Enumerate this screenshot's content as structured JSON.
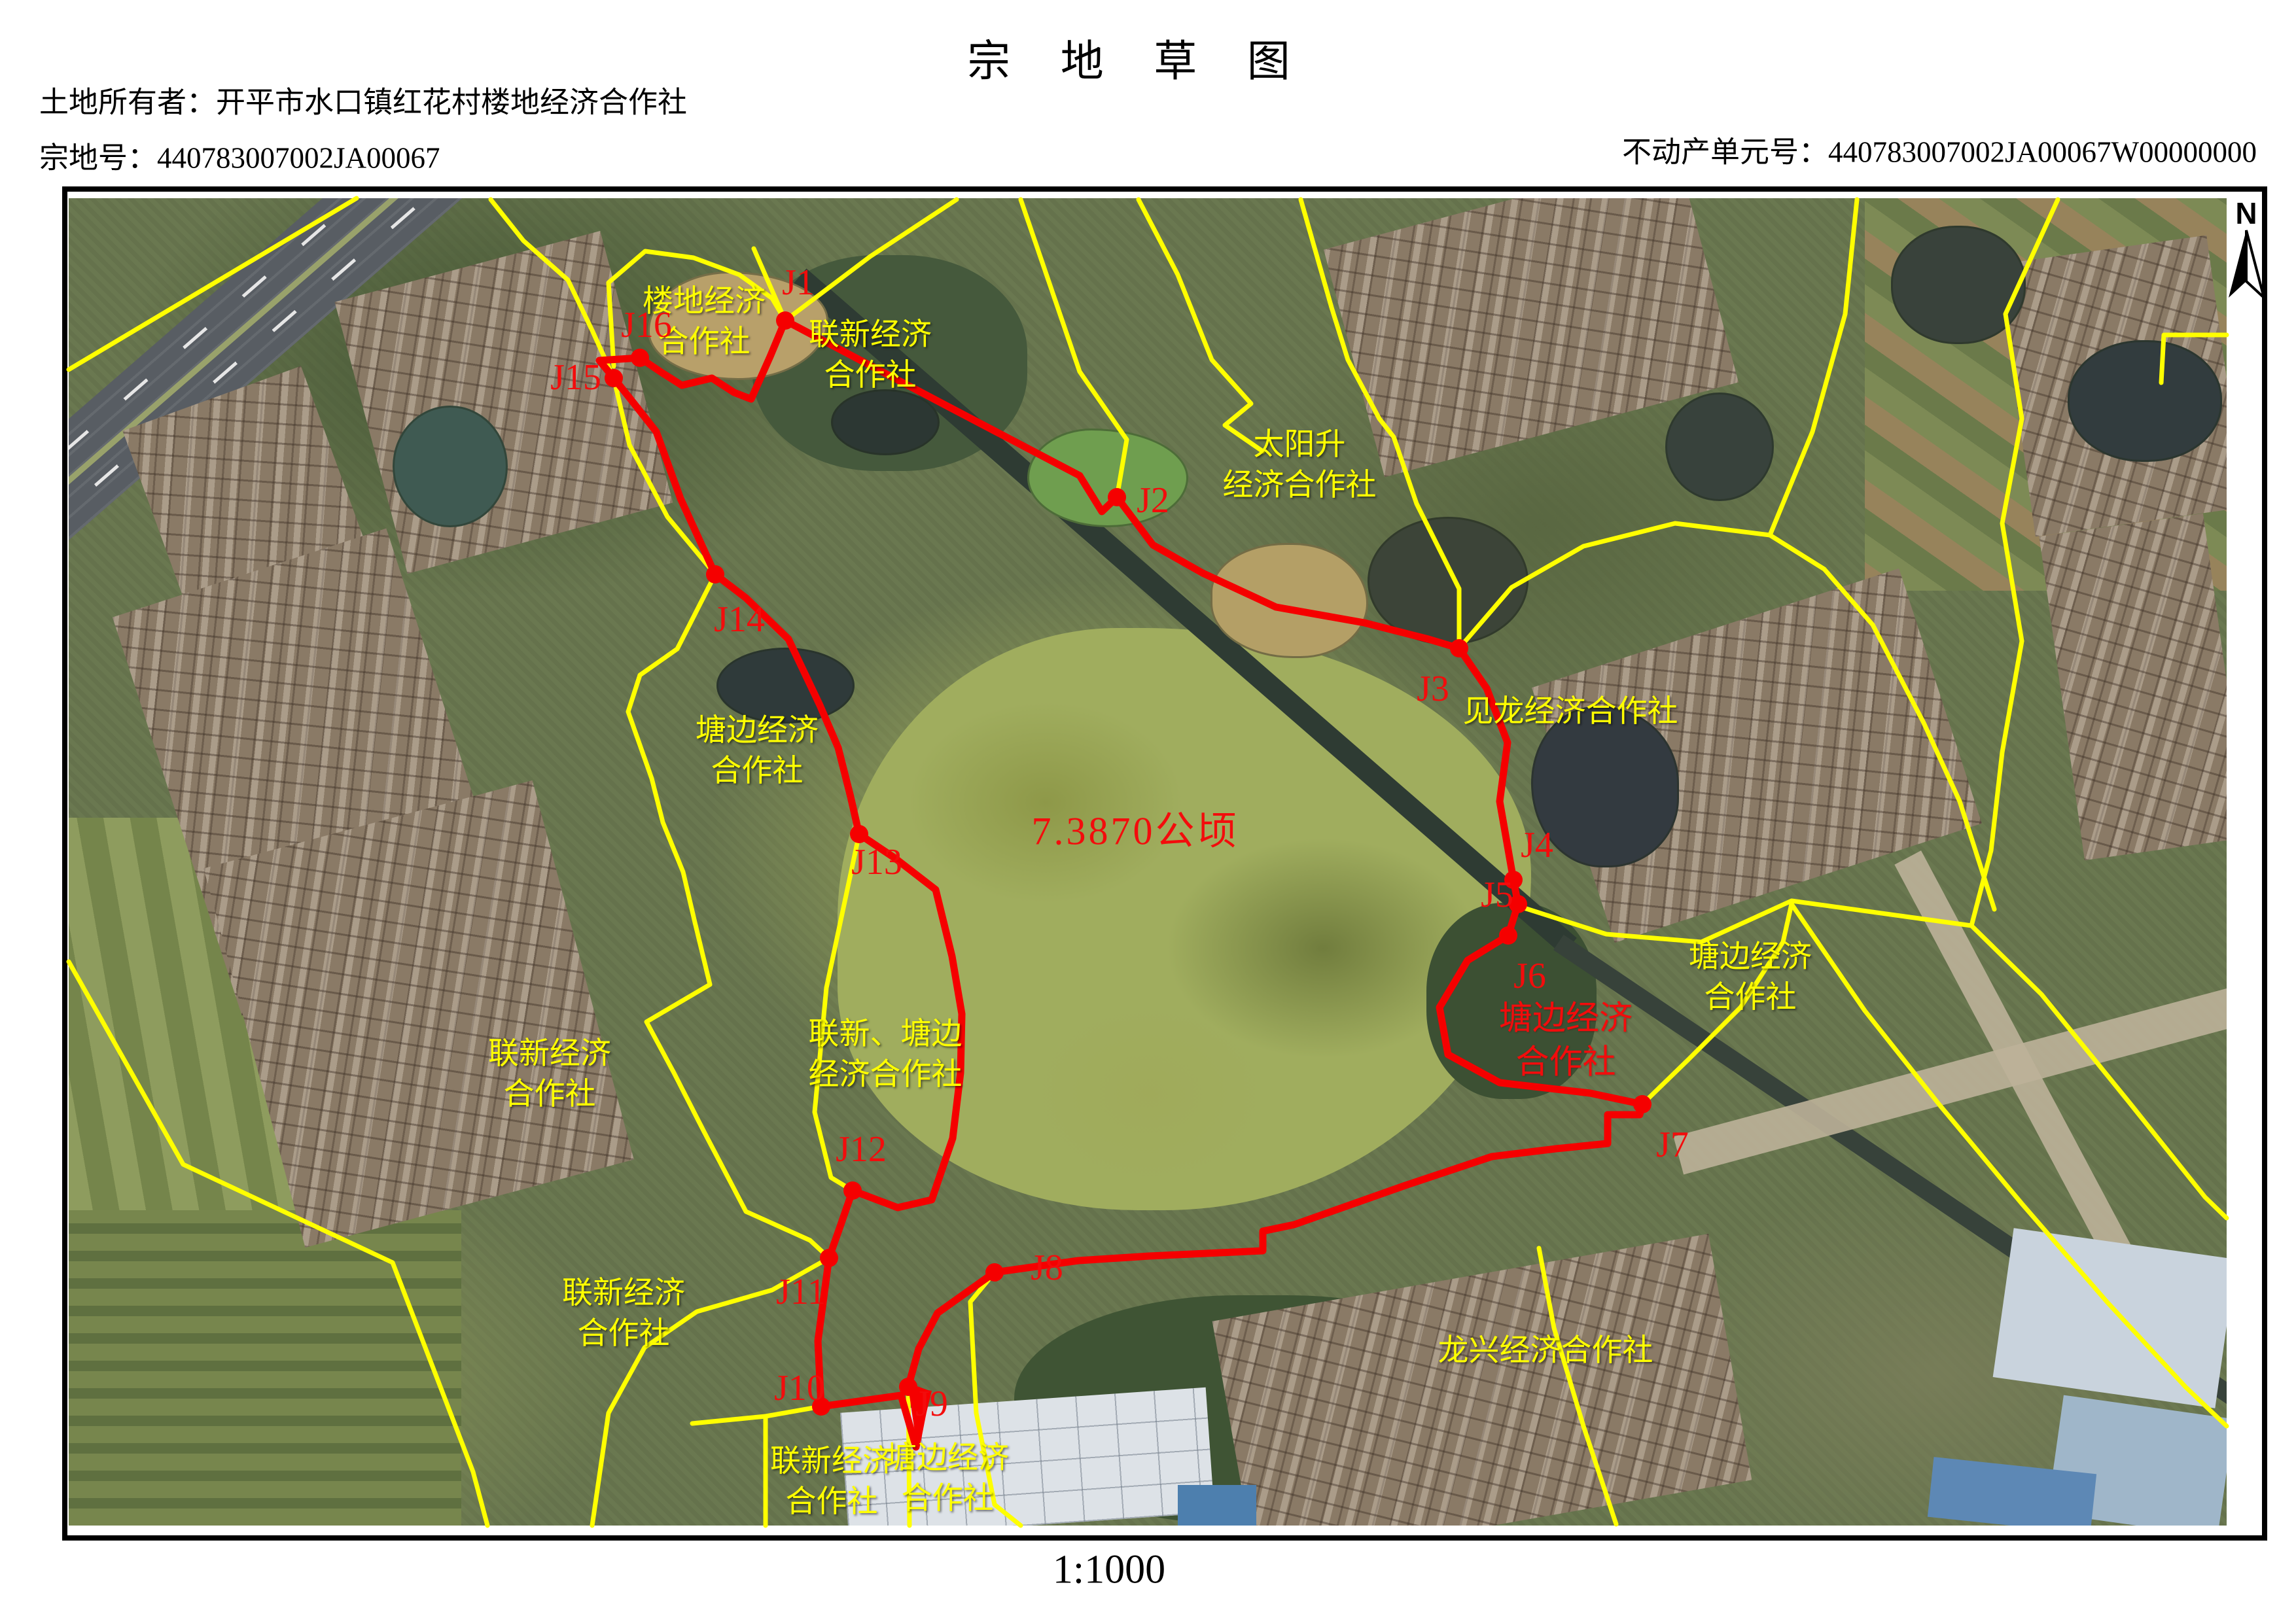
{
  "header": {
    "title": "宗 地 草 图",
    "owner": "土地所有者：开平市水口镇红花村楼地经济合作社",
    "parcel_no": "宗地号：440783007002JA00067",
    "unit_no": "不动产单元号：440783007002JA00067W00000000"
  },
  "map": {
    "north_label": "N",
    "scale_label": "1:1000",
    "area_label": "7.3870公顷",
    "points": [
      {
        "id": "J1"
      },
      {
        "id": "J2"
      },
      {
        "id": "J3"
      },
      {
        "id": "J4"
      },
      {
        "id": "J5"
      },
      {
        "id": "J6"
      },
      {
        "id": "J7"
      },
      {
        "id": "J8"
      },
      {
        "id": "J9"
      },
      {
        "id": "J10"
      },
      {
        "id": "J11"
      },
      {
        "id": "J12"
      },
      {
        "id": "J13"
      },
      {
        "id": "J14"
      },
      {
        "id": "J15"
      },
      {
        "id": "J16"
      }
    ],
    "yellow_labels": [
      {
        "text": "楼地经济\n合作社"
      },
      {
        "text": "联新经济\n合作社"
      },
      {
        "text": "太阳升\n经济合作社"
      },
      {
        "text": "见龙经济合作社"
      },
      {
        "text": "塘边经济\n合作社"
      },
      {
        "text": "联新、塘边\n经济合作社"
      },
      {
        "text": "联新经济\n合作社"
      },
      {
        "text": "联新经济\n合作社"
      },
      {
        "text": "塘边经济\n合作社"
      },
      {
        "text": "联新经济\n合作社"
      },
      {
        "text": "塘边经济\n合作社"
      },
      {
        "text": "龙兴经济合作社"
      }
    ],
    "red_labels": [
      {
        "text": "塘边经济\n合作社"
      }
    ],
    "colors": {
      "boundary_red": "#f50000",
      "boundary_yellow": "#ffff00",
      "label_yellow": "#ffff00",
      "label_red": "#f30c0c"
    }
  }
}
